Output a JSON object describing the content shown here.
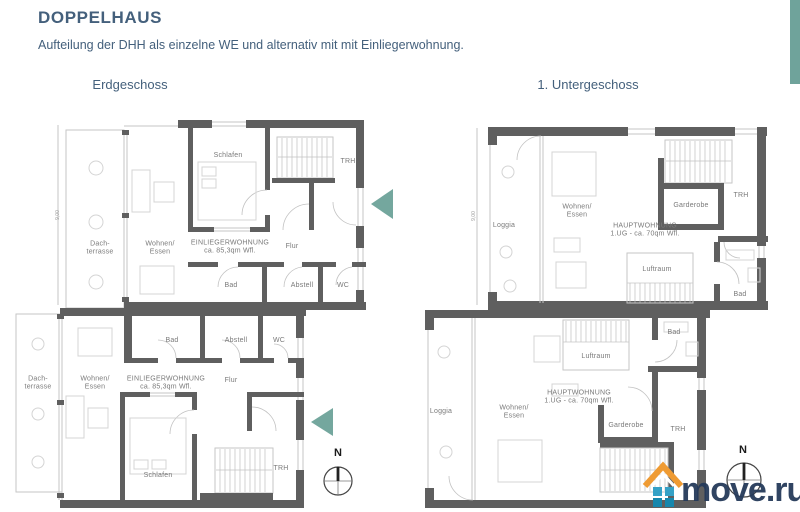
{
  "header": {
    "title": "DOPPELHAUS",
    "subtitle": "Aufteilung der DHH als einzelne WE und alternativ mit mit Einliegerwohnung.",
    "accent_color": "#6FA39B"
  },
  "plans": {
    "left_title": "Erdgeschoss",
    "right_title": "1. Untergeschoss"
  },
  "labels": {
    "schlafen": "Schlafen",
    "trh": "TRH",
    "dachterrasse": "Dach-\nterrasse",
    "wohnen_essen": "Wohnen/\nEssen",
    "einliegerwohnung": "EINLIEGERWOHNUNG\nca. 85,3qm Wfl.",
    "flur": "Flur",
    "bad": "Bad",
    "abstell": "Abstell",
    "wc": "WC",
    "loggia": "Loggia",
    "hauptwohnung": "HAUPTWOHNUNG\n1.UG - ca. 70qm Wfl.",
    "garderobe": "Garderobe",
    "luftraum": "Luftraum",
    "dimension": "9,00",
    "compass_north": "N"
  },
  "watermark": {
    "text": "move.ru",
    "text_color": "#253A5A",
    "roof_color": "#EF9B33",
    "square_color_top": "#35A1C6",
    "square_color_bottom": "#1687AD"
  },
  "colors": {
    "wall": "#5F5F5F",
    "thin_line": "#C6C6C6",
    "arrow_teal": "#74A79E",
    "header_text": "#44607C",
    "label_text": "#7A7A7A"
  }
}
